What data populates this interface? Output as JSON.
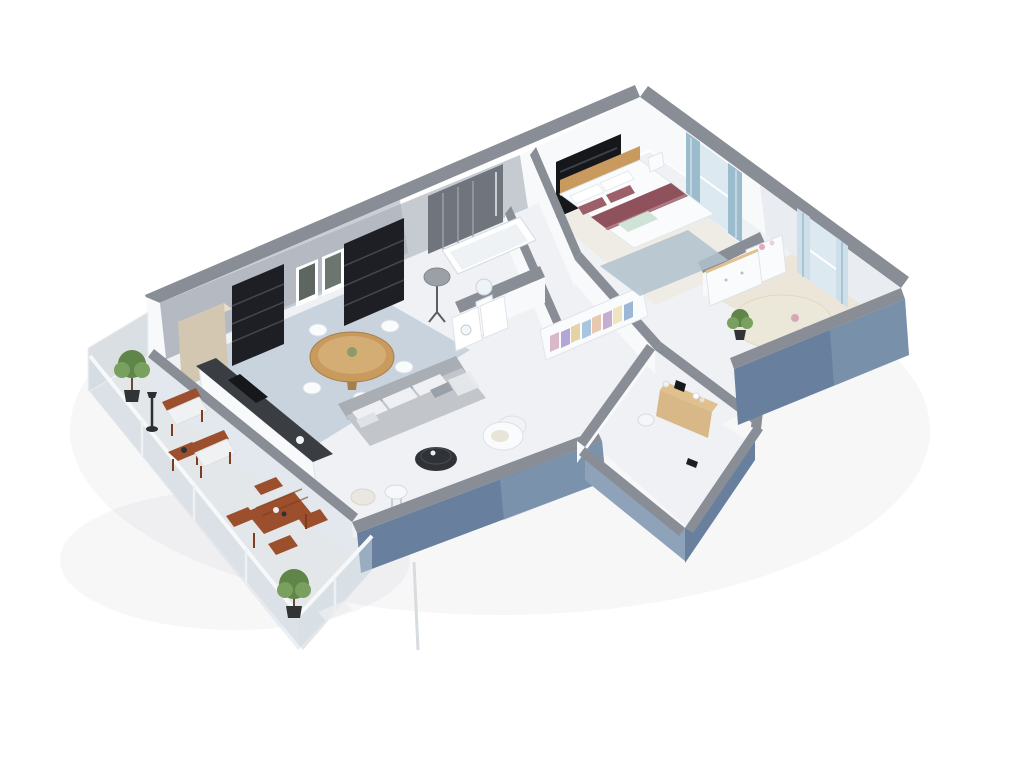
{
  "scene": {
    "title": "3D isometric dollhouse floor plan of a two-bedroom apartment with wrap-around terrace",
    "background": "#ffffff",
    "rooms": [
      {
        "name": "living-room",
        "items": [
          "grey-corner-sofa",
          "black-round-coffee-table",
          "white-lounge-chair",
          "white-side-table",
          "cream-pouf",
          "round-wood-dining-table",
          "white-dining-chairs",
          "black-bookshelves",
          "framed-wall-art",
          "grey-floor-lamp"
        ]
      },
      {
        "name": "kitchen",
        "items": [
          "tall-beige-cabinet",
          "dark-countertop",
          "black-cooktop"
        ]
      },
      {
        "name": "bathroom",
        "items": [
          "dark-tiled-shower-wall",
          "white-bathtub",
          "pedestal-sink",
          "round-mirror",
          "white-cabinets"
        ]
      },
      {
        "name": "hallway",
        "items": [
          "open-wardrobe-with-clothes"
        ]
      },
      {
        "name": "master-bedroom",
        "items": [
          "double-bed",
          "red-striped-duvet",
          "wood-headboard",
          "dark-tv-panel",
          "blue-curtain-windows",
          "blue-grey-rug",
          "nightstand"
        ]
      },
      {
        "name": "nursery",
        "items": [
          "changing-table",
          "white-dresser",
          "round-cream-rug",
          "potted-plant",
          "blue-curtain-window"
        ]
      },
      {
        "name": "entrance",
        "items": [
          "wood-console-table",
          "laundry-basket"
        ]
      },
      {
        "name": "terrace",
        "items": [
          "wooden-armchairs",
          "wooden-side-table",
          "folding-dining-table",
          "folding-chairs",
          "topiary-trees",
          "outdoor-lamp",
          "glass-balustrade",
          "privacy-screen"
        ]
      }
    ],
    "colors": {
      "background": "#ffffff",
      "floor": "#eff1f4",
      "terrace_floor": "#e4e7ea",
      "kitchen_floor": "#9cafc0",
      "wood_floor_pale": "#efe7d8",
      "nursery_floor": "#eadfc8",
      "wall_top": "#898e96",
      "wall_white": "#f7f9fa",
      "wall_white_shade": "#e3e8ee",
      "wall_grey": "#a8aeb7",
      "wall_grey_light": "#c6cbd2",
      "exterior_blue": "#68809e",
      "exterior_blue_light": "#8ea3b9",
      "glass": "#ccd9e2",
      "screen_grey": "#d9dee3",
      "shelf_black": "#1d1f24",
      "tile_dark": "#70757d",
      "tv_black": "#15171b",
      "art_dark": "#5d6660",
      "wood": "#c99a5e",
      "wood_light": "#e0c08c",
      "wood_dark": "#a87e49",
      "console_wood": "#d8b887",
      "cabinet_beige": "#d3c7b2",
      "cabinet_beige_light": "#e6ddcc",
      "counter_dark": "#3a3e43",
      "terrace_wood": "#9c4f2c",
      "terrace_wood_dark": "#7e3d1f",
      "sofa": "#c2c6cb",
      "sofa_dark": "#a9aeb5",
      "cushion_white": "#eff0f3",
      "white_furniture": "#fafbfc",
      "coffee_table": "#2f3237",
      "duvet_red": "#8f515b",
      "pillow_red": "#9d5f69",
      "blanket_mint": "#cfe4d6",
      "rug_blue": "#b0c2ce",
      "rug_cream": "#ebe8da",
      "curtain_blue": "#9bbccd",
      "curtain_pale": "#cfdfe9",
      "window_glass": "#dce9f1",
      "plant_green": "#5f8549",
      "plant_green_light": "#79a05e",
      "pot_dark": "#313335",
      "lamp_grey": "#9aa0a6",
      "clothes": [
        "#d9b8c7",
        "#b3a5d6",
        "#e6d3a4",
        "#a9c6de",
        "#e8c9b0",
        "#c5aed0",
        "#f0e3c0",
        "#9db8d6"
      ]
    }
  }
}
